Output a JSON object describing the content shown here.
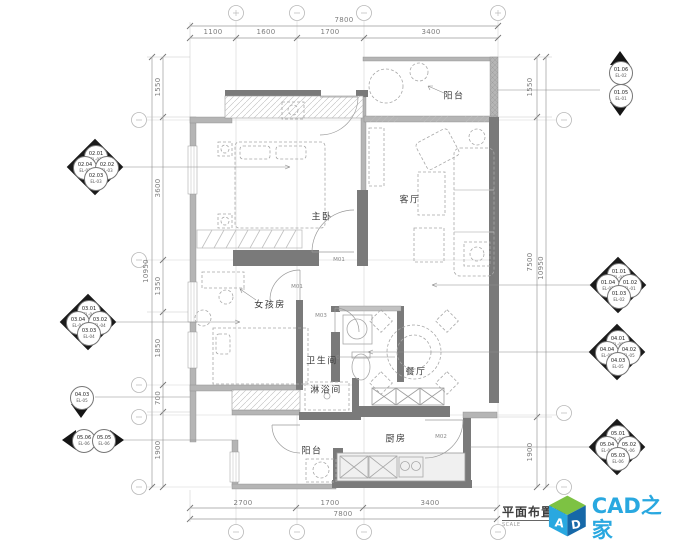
{
  "title_block": {
    "title": "平面布置图",
    "scale": "SCALE"
  },
  "logo": {
    "name": "CAD之家",
    "url": "WWW.CADZJ.COM",
    "cube_text": "AD",
    "colors": {
      "blue": "#29a8e0",
      "green": "#7dc243",
      "dark_blue": "#1668a8",
      "url_gray": "#8fa3ad"
    }
  },
  "rooms": [
    {
      "label": "阳台",
      "x": 454,
      "y": 95
    },
    {
      "label": "客厅",
      "x": 410,
      "y": 199
    },
    {
      "label": "主卧",
      "x": 322,
      "y": 216
    },
    {
      "label": "女孩房",
      "x": 270,
      "y": 304
    },
    {
      "label": "卫生间",
      "x": 322,
      "y": 360
    },
    {
      "label": "淋浴间",
      "x": 326,
      "y": 389
    },
    {
      "label": "餐厅",
      "x": 416,
      "y": 371
    },
    {
      "label": "厨房",
      "x": 396,
      "y": 438
    },
    {
      "label": "阳台",
      "x": 312,
      "y": 450
    }
  ],
  "door_labels": [
    {
      "label": "M01",
      "x": 339,
      "y": 260
    },
    {
      "label": "M01",
      "x": 297,
      "y": 287
    },
    {
      "label": "M03",
      "x": 321,
      "y": 316
    },
    {
      "label": "M02",
      "x": 441,
      "y": 437
    }
  ],
  "dimensions": {
    "top": {
      "total": {
        "text": "7800",
        "x": 344,
        "y": 20
      },
      "segments": [
        {
          "text": "1100",
          "x": 213,
          "y": 32
        },
        {
          "text": "1600",
          "x": 266,
          "y": 32
        },
        {
          "text": "1700",
          "x": 330,
          "y": 32
        },
        {
          "text": "3400",
          "x": 431,
          "y": 32
        }
      ]
    },
    "bottom": {
      "total": {
        "text": "7800",
        "x": 343,
        "y": 514
      },
      "segments": [
        {
          "text": "2700",
          "x": 243,
          "y": 503
        },
        {
          "text": "1700",
          "x": 330,
          "y": 503
        },
        {
          "text": "3400",
          "x": 430,
          "y": 503
        }
      ]
    },
    "left": {
      "total": {
        "text": "10950",
        "x": 146,
        "y": 271
      },
      "segments": [
        {
          "text": "1550",
          "x": 158,
          "y": 87
        },
        {
          "text": "3600",
          "x": 158,
          "y": 188
        },
        {
          "text": "1350",
          "x": 158,
          "y": 286
        },
        {
          "text": "1850",
          "x": 158,
          "y": 348
        },
        {
          "text": "700",
          "x": 158,
          "y": 398
        },
        {
          "text": "1900",
          "x": 158,
          "y": 450
        }
      ]
    },
    "right": {
      "total": {
        "text": "10950",
        "x": 541,
        "y": 268
      },
      "segments": [
        {
          "text": "1550",
          "x": 530,
          "y": 87
        },
        {
          "text": "7500",
          "x": 530,
          "y": 262
        },
        {
          "text": "1900",
          "x": 530,
          "y": 452
        }
      ]
    }
  },
  "markers": [
    {
      "type": "quad",
      "x": 95,
      "y": 167,
      "items": {
        "n": [
          "02.01",
          "EL-03"
        ],
        "w": [
          "02.04",
          "EL-03"
        ],
        "e": [
          "02.02",
          "EL-03"
        ],
        "s": [
          "02.03",
          "EL-03"
        ]
      }
    },
    {
      "type": "quad",
      "x": 88,
      "y": 322,
      "items": {
        "n": [
          "03.01",
          "EL-04"
        ],
        "w": [
          "03.04",
          "EL-04"
        ],
        "e": [
          "03.02",
          "EL-04"
        ],
        "s": [
          "03.03",
          "EL-04"
        ]
      }
    },
    {
      "type": "down",
      "x": 81,
      "y": 397,
      "items": {
        "c": [
          "04.03",
          "EL-05"
        ]
      }
    },
    {
      "type": "left",
      "x": 83,
      "y": 440,
      "items": {
        "c": [
          "05.06",
          "EL-06"
        ]
      }
    },
    {
      "type": "right",
      "x": 103,
      "y": 440,
      "items": {
        "c": [
          "05.05",
          "EL-06"
        ]
      }
    },
    {
      "type": "up",
      "x": 620,
      "y": 72,
      "items": {
        "c": [
          "01.06",
          "EL-02"
        ]
      }
    },
    {
      "type": "down",
      "x": 620,
      "y": 95,
      "items": {
        "c": [
          "01.05",
          "EL-01"
        ]
      }
    },
    {
      "type": "quad",
      "x": 618,
      "y": 285,
      "items": {
        "n": [
          "01.01",
          "EL-01"
        ],
        "w": [
          "01.04",
          "EL-02"
        ],
        "e": [
          "01.02",
          "EL-01"
        ],
        "s": [
          "01.03",
          "EL-02"
        ]
      }
    },
    {
      "type": "quad",
      "x": 617,
      "y": 352,
      "items": {
        "n": [
          "04.01",
          "EL-05"
        ],
        "w": [
          "04.04",
          "EL-05"
        ],
        "e": [
          "04.02",
          "EL-05"
        ],
        "s": [
          "04.03",
          "EL-05"
        ]
      }
    },
    {
      "type": "quad",
      "x": 617,
      "y": 447,
      "items": {
        "n": [
          "05.01",
          "EL-06"
        ],
        "w": [
          "05.04",
          "EL-06"
        ],
        "e": [
          "05.02",
          "EL-06"
        ],
        "s": [
          "05.03",
          "EL-06"
        ]
      }
    }
  ]
}
